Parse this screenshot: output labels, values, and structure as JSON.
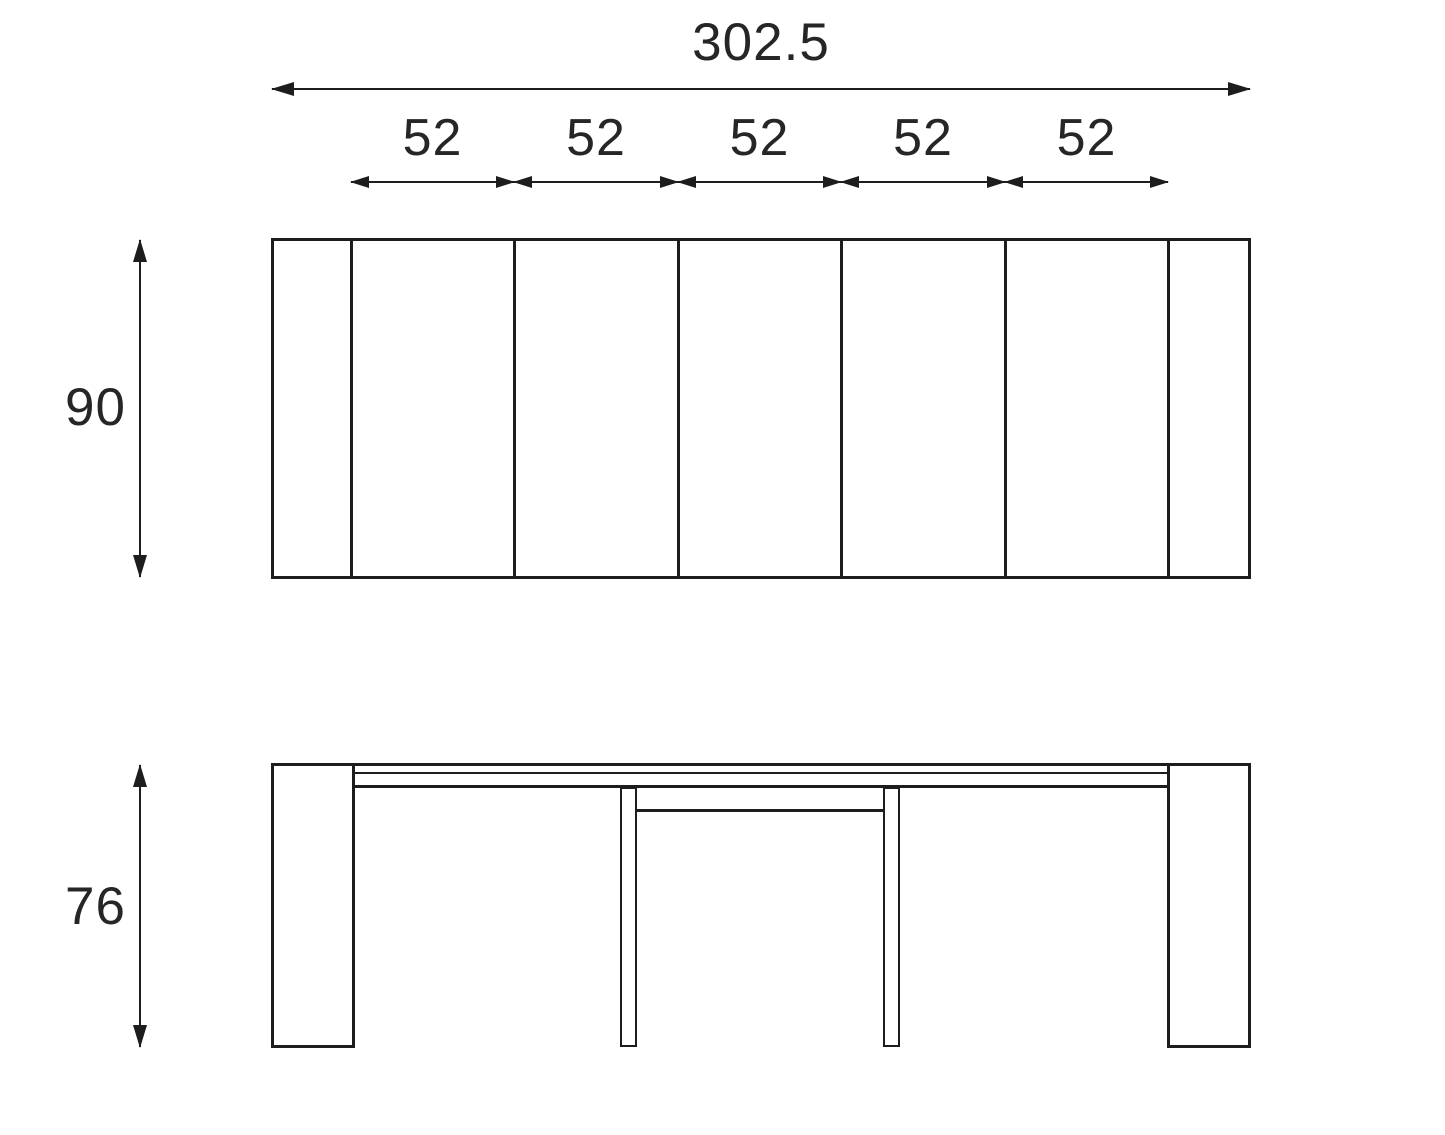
{
  "dimensions": {
    "overall_width": "302.5",
    "sections": [
      "52",
      "52",
      "52",
      "52",
      "52"
    ],
    "depth": "90",
    "height": "76"
  },
  "colors": {
    "ink": "#1d1d1d",
    "background": "#ffffff"
  }
}
